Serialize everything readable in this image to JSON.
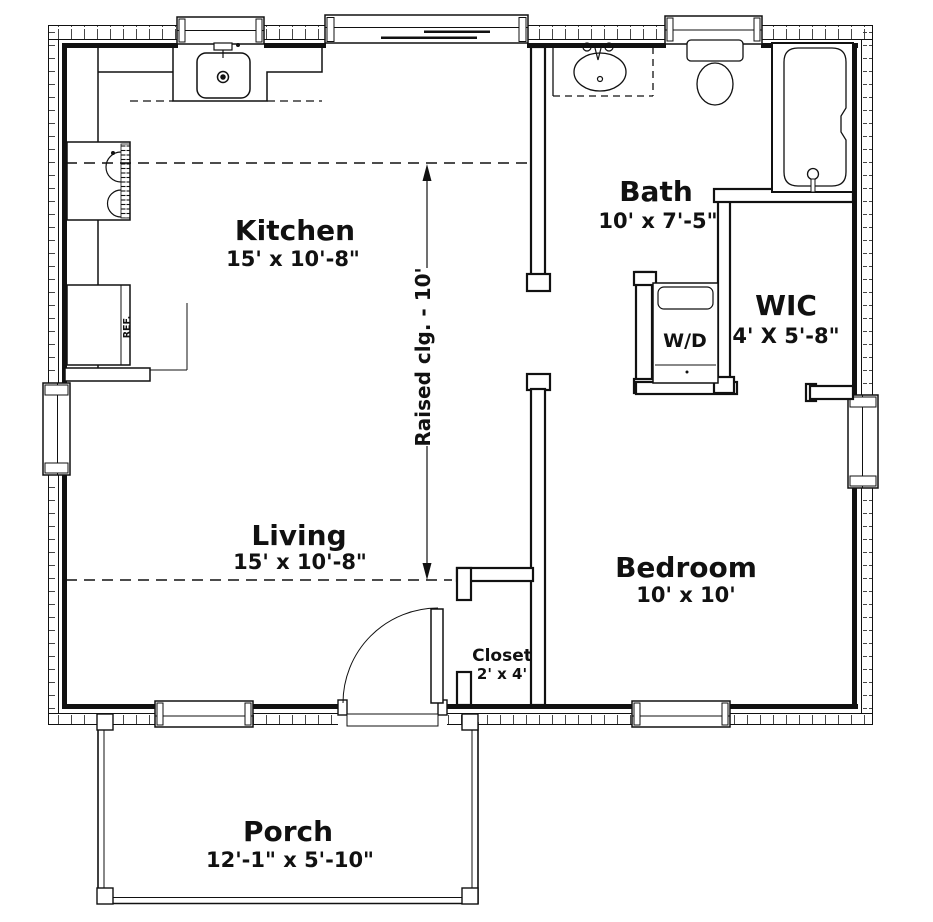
{
  "plan": {
    "rooms": {
      "kitchen": {
        "name": "Kitchen",
        "dims": "15' x 10'-8\""
      },
      "bath": {
        "name": "Bath",
        "dims": "10' x 7'-5\""
      },
      "wic": {
        "name": "WIC",
        "dims": "4' X 5'-8\""
      },
      "living": {
        "name": "Living",
        "dims": "15' x 10'-8\""
      },
      "bedroom": {
        "name": "Bedroom",
        "dims": "10' x 10'"
      },
      "closet": {
        "name": "Closet",
        "dims": "2' x 4'"
      },
      "porch": {
        "name": "Porch",
        "dims": "12'-1\" x 5'-10\""
      }
    },
    "labels": {
      "raised_ceiling": "Raised clg. - 10'",
      "washer_dryer": "W/D",
      "refrigerator": "REF."
    },
    "colors": {
      "line": "#111111",
      "background": "#ffffff"
    }
  }
}
